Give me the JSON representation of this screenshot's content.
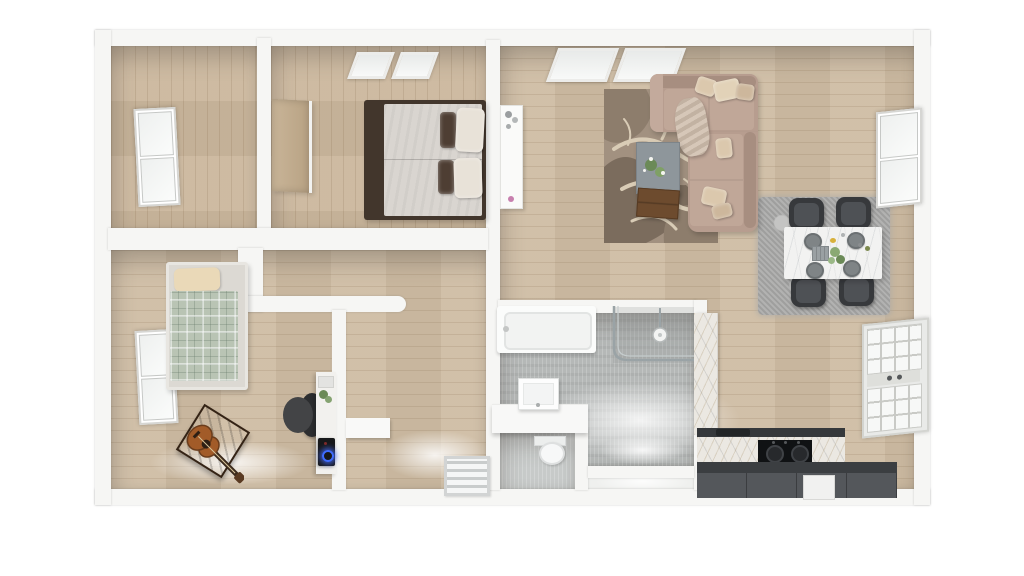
{
  "scene": {
    "type": "3d_floor_plan_top_down_render",
    "style": "photoreal architectural top view, white walls, oak wood floors, no visible text",
    "visible_text": []
  },
  "colors": {
    "wall": "#f6f6f4",
    "wall-edge": "#e2e2df",
    "wood": "#cbb79d",
    "wood-living": "#cfbda4",
    "tile": "#b5b8b7",
    "tile-light": "#c7cac9",
    "sofa": "#b79d8f",
    "sofa-back": "#a78e80",
    "sofa-seat": "#c0a798",
    "cushion": "#dbc8ad",
    "rug-base": "#a29180",
    "rug-dark": "#7b6c5d",
    "rug-cream": "#d9ccb6",
    "rug-dining": "#a9a9a8",
    "chair": "#37393c",
    "counter-top": "#35383b",
    "cabinet": "#54575b",
    "bed-frame": "#42362c",
    "mattress": "#d9d5d0",
    "pillow-dark": "#4e3e33",
    "plaid": "#b9c4b4",
    "amp": "#5a3a24",
    "guitar-body": "#a25b28",
    "plant": "#6b8a57",
    "pc-glow": "#3f6cff",
    "toilet-white": "#f7f8f8",
    "pink-decor": "#c77fae"
  },
  "rooms": [
    {
      "id": "bedroom-main",
      "furniture": [
        "double-bed",
        "two-cream-pillows",
        "two-brown-pillows",
        "skylight-window",
        "open-wood-door-panel"
      ]
    },
    {
      "id": "study-room",
      "furniture": [
        "window"
      ]
    },
    {
      "id": "living-dining-room",
      "furniture": [
        "sectional-sofa",
        "throw-pillows",
        "throw-blanket",
        "patterned-area-rug",
        "coffee-table",
        "flowers",
        "wooden-tray",
        "wall-sideboard",
        "skylight-window",
        "marble-dining-table",
        "dining-chairs-x4",
        "place-settings-x4",
        "shag-rug",
        "window",
        "glazed-patio-door"
      ]
    },
    {
      "id": "kitchen",
      "furniture": [
        "marble-counter",
        "gas-range-two-burners",
        "sink",
        "dark-island-cabinets",
        "built-in-appliance",
        "marble-wall-panel"
      ]
    },
    {
      "id": "bathroom",
      "furniture": [
        "bathtub",
        "walk-in-glass-shower",
        "shower-head",
        "wall-hung-basin",
        "vanity-counter"
      ]
    },
    {
      "id": "wc",
      "furniture": [
        "toilet"
      ]
    },
    {
      "id": "bedroom-second",
      "furniture": [
        "single-bed-plaid-blanket",
        "window",
        "electric-guitar",
        "guitar-amplifier",
        "office-chair",
        "desk",
        "gaming-pc-blue-led",
        "desk-plant"
      ]
    },
    {
      "id": "hallway",
      "furniture": [
        "slatted-floor-mat",
        "wall-shelf"
      ]
    }
  ]
}
